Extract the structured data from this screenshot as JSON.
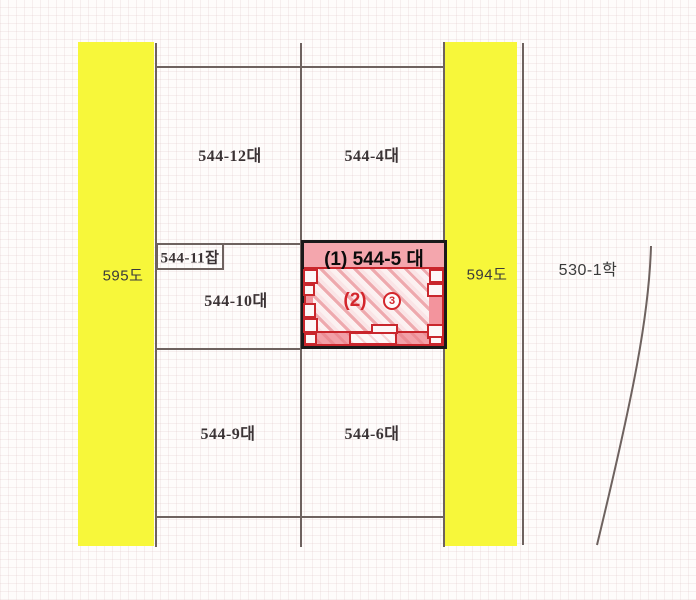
{
  "colors": {
    "road_yellow": "#F7F73A",
    "boundary_line": "#6E625F",
    "highlight_fill": "#F4A6AD",
    "highlight_red": "#C9262C",
    "outline_black": "#1A1A1A"
  },
  "roads": [
    {
      "label": "595도"
    },
    {
      "label": "594도"
    }
  ],
  "parcels": [
    {
      "label": "544-12대"
    },
    {
      "label": "544-4대"
    },
    {
      "label": "544-11잡"
    },
    {
      "label": "544-10대"
    },
    {
      "label": "544-9대"
    },
    {
      "label": "544-6대"
    },
    {
      "label": "530-1학"
    }
  ],
  "highlight": {
    "title": "(1) 544-5 대",
    "building_label": "(2)",
    "circled_number": "3"
  }
}
